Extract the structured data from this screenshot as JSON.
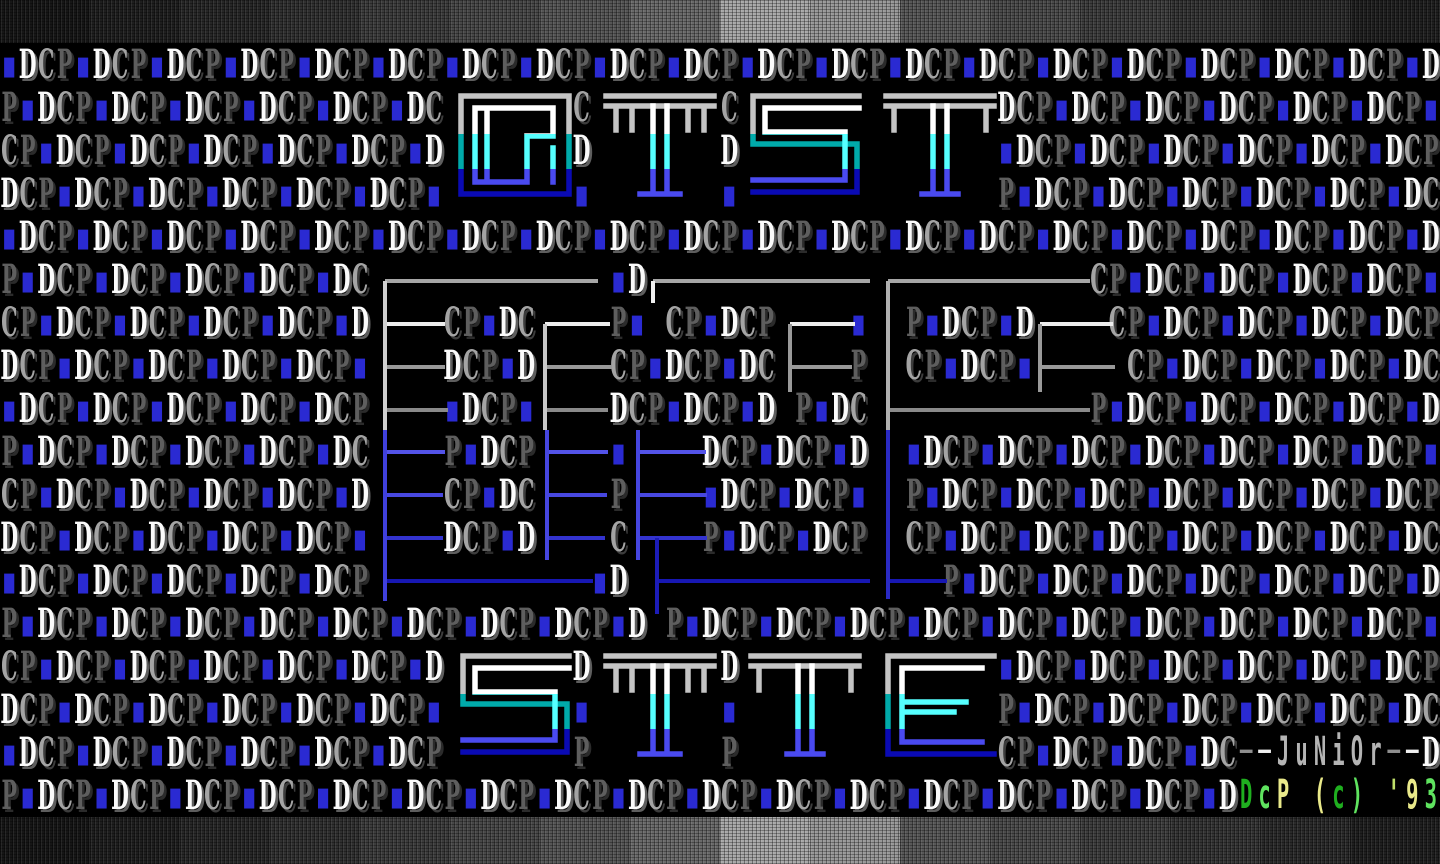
{
  "meta": {
    "title": "DCP DIST SITE ANSI screen"
  },
  "bands": {
    "top": {
      "colors": [
        "#161616",
        "#1e1e1e",
        "#272727",
        "#303030",
        "#3c3c3c",
        "#484848",
        "#565656",
        "#6a6a6a",
        "#a8a8a8",
        "#989898",
        "#585858",
        "#4b4b4b",
        "#3d3d3d",
        "#343434",
        "#2a2a2a",
        "#1f1f1f"
      ]
    },
    "bottom": {
      "colors": [
        "#161616",
        "#1e1e1e",
        "#272727",
        "#303030",
        "#3c3c3c",
        "#484848",
        "#565656",
        "#6a6a6a",
        "#a8a8a8",
        "#989898",
        "#585858",
        "#4b4b4b",
        "#3d3d3d",
        "#343434",
        "#2a2a2a",
        "#1f1f1f"
      ]
    }
  },
  "pattern": {
    "sequence": [
      "D",
      "C",
      "P",
      "·"
    ],
    "dot_glyph": "▪",
    "rows": 18,
    "cols": 78,
    "startIndex": [
      3,
      2,
      1,
      0,
      3,
      2,
      1,
      0,
      3,
      2,
      1,
      0,
      3,
      2,
      1,
      0,
      3,
      2
    ],
    "colors": {
      "D": "#fbfbfb",
      "C": "#a4a4a4",
      "P": "#5e5e5e",
      "dot": "#2a2ad2"
    }
  },
  "titles": {
    "top": {
      "text": "DIST",
      "y": 90,
      "letters": [
        {
          "ch": "D",
          "x": 455
        },
        {
          "ch": "I",
          "x": 600
        },
        {
          "ch": "S",
          "x": 745
        },
        {
          "ch": "T",
          "x": 880
        }
      ],
      "blank_ranges": [
        [
          452,
          578
        ],
        [
          597,
          713
        ],
        [
          742,
          868
        ],
        [
          877,
          1003
        ]
      ]
    },
    "bottom": {
      "text": "SITE",
      "y": 650,
      "letters": [
        {
          "ch": "S",
          "x": 455
        },
        {
          "ch": "I",
          "x": 600
        },
        {
          "ch": "T",
          "x": 745
        },
        {
          "ch": "E",
          "x": 880
        }
      ],
      "blank_ranges": [
        [
          452,
          578
        ],
        [
          597,
          713
        ],
        [
          742,
          868
        ],
        [
          877,
          1003
        ]
      ]
    }
  },
  "letter_gradient": {
    "outer": [
      "#c4c4c4",
      "#00aaaa",
      "#0a0ab4"
    ],
    "inner": [
      "#ffffff",
      "#55ffff",
      "#4a4af0"
    ],
    "stops": [
      0.4,
      0.72
    ]
  },
  "middle_art": {
    "gray": {
      "rows": [
        {
          "y": 281,
          "color": "#a6a6a6",
          "segs": [
            [
              385,
              598
            ],
            [
              653,
              870
            ],
            [
              888,
              1090
            ]
          ]
        },
        {
          "y": 324,
          "color": "#ededed",
          "segs": [
            [
              385,
              445
            ],
            [
              545,
              610
            ],
            [
              790,
              855
            ],
            [
              1040,
              1113
            ]
          ]
        },
        {
          "y": 367,
          "color": "#989898",
          "segs": [
            [
              385,
              445
            ],
            [
              545,
              612
            ],
            [
              790,
              852
            ],
            [
              1040,
              1115
            ]
          ]
        },
        {
          "y": 410,
          "color": "#8a8a8a",
          "segs": [
            [
              385,
              448
            ],
            [
              545,
              608
            ],
            [
              888,
              1090
            ]
          ]
        }
      ],
      "verticals": [
        {
          "x": 385,
          "y1": 281,
          "y2": 430,
          "color": "#d0d0d0"
        },
        {
          "x": 545,
          "y1": 324,
          "y2": 430,
          "color": "#c8c8c8"
        },
        {
          "x": 653,
          "y1": 281,
          "y2": 303,
          "color": "#f0f0f0"
        },
        {
          "x": 790,
          "y1": 324,
          "y2": 392,
          "color": "#9a9a9a"
        },
        {
          "x": 888,
          "y1": 281,
          "y2": 430,
          "color": "#b0b0b0"
        },
        {
          "x": 1040,
          "y1": 324,
          "y2": 392,
          "color": "#9a9a9a"
        }
      ]
    },
    "blue": {
      "rows": [
        {
          "y": 452,
          "color": "#5353e8",
          "segs": [
            [
              385,
              445
            ],
            [
              547,
              608
            ],
            [
              638,
              706
            ]
          ]
        },
        {
          "y": 495,
          "color": "#4747e0",
          "segs": [
            [
              385,
              443
            ],
            [
              547,
              607
            ],
            [
              638,
              707
            ]
          ]
        },
        {
          "y": 538,
          "color": "#3333cf",
          "segs": [
            [
              385,
              443
            ],
            [
              547,
              605
            ],
            [
              638,
              707
            ]
          ]
        },
        {
          "y": 581,
          "color": "#1717b2",
          "segs": [
            [
              385,
              593
            ],
            [
              657,
              870
            ],
            [
              888,
              947
            ]
          ]
        }
      ],
      "verticals": [
        {
          "x": 385,
          "y1": 430,
          "y2": 601,
          "color": "#4040dd"
        },
        {
          "x": 547,
          "y1": 430,
          "y2": 560,
          "color": "#4646e0"
        },
        {
          "x": 638,
          "y1": 430,
          "y2": 560,
          "color": "#4646e0"
        },
        {
          "x": 657,
          "y1": 538,
          "y2": 614,
          "color": "#1c1cb8"
        },
        {
          "x": 888,
          "y1": 430,
          "y2": 599,
          "color": "#2a2ac4"
        }
      ]
    }
  },
  "credits": {
    "artist": "JuNiOr",
    "artist_row": 16,
    "artist_start": 67,
    "artist_cells": [
      {
        "ch": "─",
        "color": "#8f8f8f"
      },
      {
        "ch": "─",
        "color": "#f0f0f0"
      },
      {
        "ch": "J",
        "color": "#b4b4b4"
      },
      {
        "ch": "u",
        "color": "#b4b4b4"
      },
      {
        "ch": "N",
        "color": "#b4b4b4"
      },
      {
        "ch": "i",
        "color": "#b4b4b4"
      },
      {
        "ch": "O",
        "color": "#b4b4b4"
      },
      {
        "ch": "r",
        "color": "#b4b4b4"
      },
      {
        "ch": "─",
        "color": "#8f8f8f"
      },
      {
        "ch": "─",
        "color": "#f0f0f0"
      }
    ],
    "copyright": "DcP (c) '93",
    "copyright_row": 17,
    "copyright_start": 67,
    "copyright_cells": [
      {
        "ch": "D",
        "color": "#1faf1f"
      },
      {
        "ch": "c",
        "color": "#5fe35f"
      },
      {
        "ch": "P",
        "color": "#e9e98a"
      },
      {
        "ch": " ",
        "color": "#000000"
      },
      {
        "ch": "(",
        "color": "#e9e98a"
      },
      {
        "ch": "c",
        "color": "#1faf1f"
      },
      {
        "ch": ")",
        "color": "#5fe35f"
      },
      {
        "ch": " ",
        "color": "#000000"
      },
      {
        "ch": "'",
        "color": "#bfe06a"
      },
      {
        "ch": "9",
        "color": "#e9e98a"
      },
      {
        "ch": "3",
        "color": "#5fe35f"
      }
    ]
  }
}
